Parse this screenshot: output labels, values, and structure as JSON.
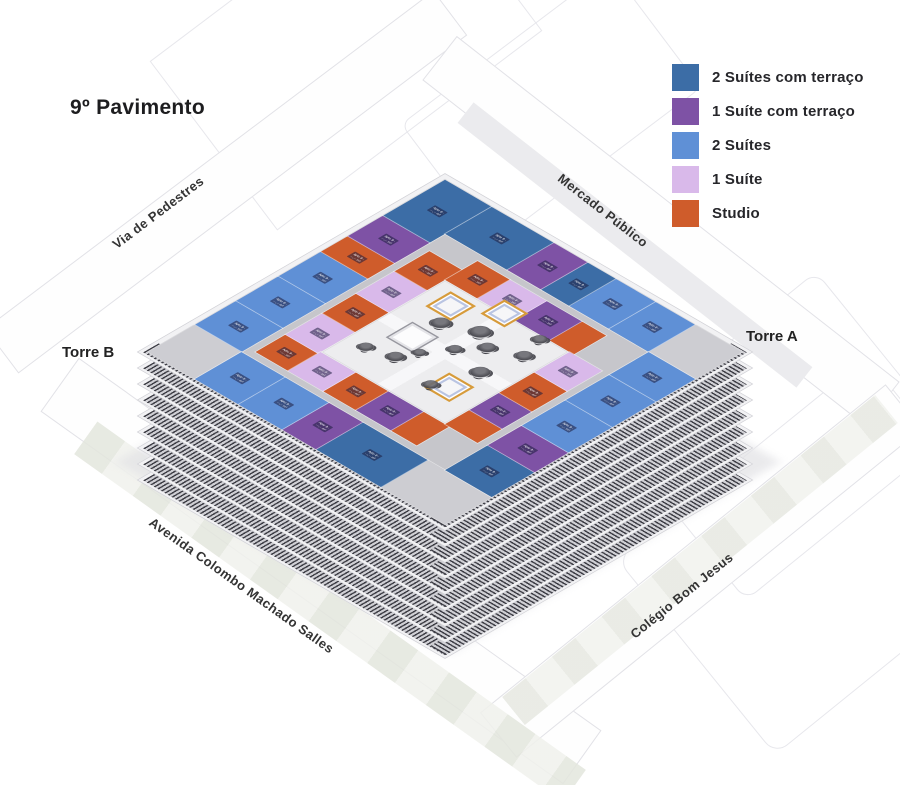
{
  "title": "9º Pavimento",
  "legend": {
    "items": [
      {
        "label": "2 Suítes com terraço",
        "color": "#3c6da6"
      },
      {
        "label": "1 Suíte com terraço",
        "color": "#7e52a5"
      },
      {
        "label": "2 Suítes",
        "color": "#5f90d6"
      },
      {
        "label": "1 Suíte",
        "color": "#d9b9ea"
      },
      {
        "label": "Studio",
        "color": "#cf5c2b"
      }
    ]
  },
  "map_labels": {
    "street_top_left": "Via de Pedestres",
    "street_top_right": "Mercado Público",
    "street_bottom_left": "Avenida Colombo Machado Salles",
    "street_bottom_right": "Colégio Bom Jesus",
    "tower_left": "Torre B",
    "tower_right": "Torre A"
  },
  "floorplan": {
    "unit_types": {
      "suite2_terraco": {
        "label": "2 Suítes com terraço",
        "color": "#3c6da6"
      },
      "suite1_terraco": {
        "label": "1 Suíte com terraço",
        "color": "#7e52a5"
      },
      "suites2": {
        "label": "2 Suítes",
        "color": "#5f90d6"
      },
      "suite1": {
        "label": "1 Suíte",
        "color": "#d9b9ea"
      },
      "studio": {
        "label": "Studio",
        "color": "#cf5c2b"
      },
      "core": {
        "label": "Área comum",
        "color": "#cdcdd2"
      }
    },
    "unit_label": {
      "line1": "Apto 9··",
      "line2": "···,·· m²"
    },
    "slab_count": 8,
    "units": [
      {
        "x": 0,
        "y": 0,
        "w": 66,
        "h": 88,
        "t": "suite2_terraco"
      },
      {
        "x": 0,
        "y": 88,
        "w": 66,
        "h": 50,
        "t": "suite1_terraco"
      },
      {
        "x": 0,
        "y": 138,
        "w": 66,
        "h": 38,
        "t": "studio"
      },
      {
        "x": 0,
        "y": 176,
        "w": 66,
        "h": 60,
        "t": "suites2"
      },
      {
        "x": 0,
        "y": 236,
        "w": 66,
        "h": 60,
        "t": "suites2"
      },
      {
        "x": 0,
        "y": 296,
        "w": 66,
        "h": 58,
        "t": "suites2"
      },
      {
        "x": 0,
        "y": 354,
        "w": 66,
        "h": 66,
        "t": "core"
      },
      {
        "x": 66,
        "y": 0,
        "w": 88,
        "h": 66,
        "t": "suite2_terraco"
      },
      {
        "x": 154,
        "y": 0,
        "w": 48,
        "h": 66,
        "t": "suite1_terraco"
      },
      {
        "x": 202,
        "y": 0,
        "w": 40,
        "h": 66,
        "t": "suite2_terraco"
      },
      {
        "x": 242,
        "y": 0,
        "w": 56,
        "h": 66,
        "t": "suites2"
      },
      {
        "x": 298,
        "y": 0,
        "w": 56,
        "h": 66,
        "t": "suites2"
      },
      {
        "x": 354,
        "y": 0,
        "w": 66,
        "h": 66,
        "t": "core"
      },
      {
        "x": 66,
        "y": 354,
        "w": 62,
        "h": 66,
        "t": "suites2"
      },
      {
        "x": 128,
        "y": 354,
        "w": 62,
        "h": 66,
        "t": "suites2"
      },
      {
        "x": 190,
        "y": 354,
        "w": 48,
        "h": 66,
        "t": "suite1_terraco"
      },
      {
        "x": 238,
        "y": 354,
        "w": 92,
        "h": 66,
        "t": "suite2_terraco"
      },
      {
        "x": 330,
        "y": 354,
        "w": 90,
        "h": 66,
        "t": "core"
      },
      {
        "x": 354,
        "y": 66,
        "w": 66,
        "h": 56,
        "t": "suites2"
      },
      {
        "x": 354,
        "y": 122,
        "w": 66,
        "h": 62,
        "t": "suites2"
      },
      {
        "x": 354,
        "y": 184,
        "w": 66,
        "h": 62,
        "t": "suites2"
      },
      {
        "x": 354,
        "y": 246,
        "w": 66,
        "h": 48,
        "t": "suite1_terraco"
      },
      {
        "x": 354,
        "y": 294,
        "w": 66,
        "h": 60,
        "t": "suite2_terraco"
      },
      {
        "x": 76,
        "y": 98,
        "w": 46,
        "h": 50,
        "t": "studio"
      },
      {
        "x": 76,
        "y": 148,
        "w": 46,
        "h": 54,
        "t": "suite1"
      },
      {
        "x": 76,
        "y": 202,
        "w": 46,
        "h": 48,
        "t": "studio"
      },
      {
        "x": 76,
        "y": 250,
        "w": 46,
        "h": 52,
        "t": "suite1"
      },
      {
        "x": 76,
        "y": 302,
        "w": 46,
        "h": 42,
        "t": "studio"
      },
      {
        "x": 122,
        "y": 76,
        "w": 46,
        "h": 46,
        "t": "studio"
      },
      {
        "x": 168,
        "y": 76,
        "w": 52,
        "h": 46,
        "t": "suite1"
      },
      {
        "x": 220,
        "y": 76,
        "w": 50,
        "h": 46,
        "t": "suite1_terraco"
      },
      {
        "x": 270,
        "y": 76,
        "w": 34,
        "h": 46,
        "t": "studio"
      },
      {
        "x": 122,
        "y": 298,
        "w": 50,
        "h": 46,
        "t": "suite1"
      },
      {
        "x": 172,
        "y": 298,
        "w": 46,
        "h": 46,
        "t": "studio"
      },
      {
        "x": 218,
        "y": 298,
        "w": 50,
        "h": 46,
        "t": "suite1_terraco"
      },
      {
        "x": 268,
        "y": 298,
        "w": 36,
        "h": 46,
        "t": "studio"
      },
      {
        "x": 298,
        "y": 122,
        "w": 46,
        "h": 50,
        "t": "suite1"
      },
      {
        "x": 298,
        "y": 172,
        "w": 46,
        "h": 50,
        "t": "studio"
      },
      {
        "x": 298,
        "y": 222,
        "w": 46,
        "h": 42,
        "t": "suite1_terraco"
      },
      {
        "x": 298,
        "y": 264,
        "w": 46,
        "h": 34,
        "t": "studio"
      }
    ],
    "courtyard": {
      "pool": {
        "x": 150,
        "y": 196,
        "w": 34,
        "h": 34
      },
      "pergolas": [
        {
          "x": 140,
          "y": 132,
          "s": 30
        },
        {
          "x": 188,
          "y": 104,
          "s": 28
        },
        {
          "x": 238,
          "y": 232,
          "s": 30
        }
      ],
      "trees": [
        {
          "x": 162,
          "y": 168,
          "s": 20
        },
        {
          "x": 200,
          "y": 150,
          "s": 22
        },
        {
          "x": 226,
          "y": 166,
          "s": 18
        },
        {
          "x": 206,
          "y": 192,
          "s": 16
        },
        {
          "x": 250,
          "y": 200,
          "s": 20
        },
        {
          "x": 172,
          "y": 242,
          "s": 18
        },
        {
          "x": 232,
          "y": 252,
          "s": 16
        },
        {
          "x": 262,
          "y": 150,
          "s": 18
        },
        {
          "x": 140,
          "y": 252,
          "s": 16
        },
        {
          "x": 254,
          "y": 120,
          "s": 16
        },
        {
          "x": 186,
          "y": 222,
          "s": 14
        }
      ]
    }
  }
}
